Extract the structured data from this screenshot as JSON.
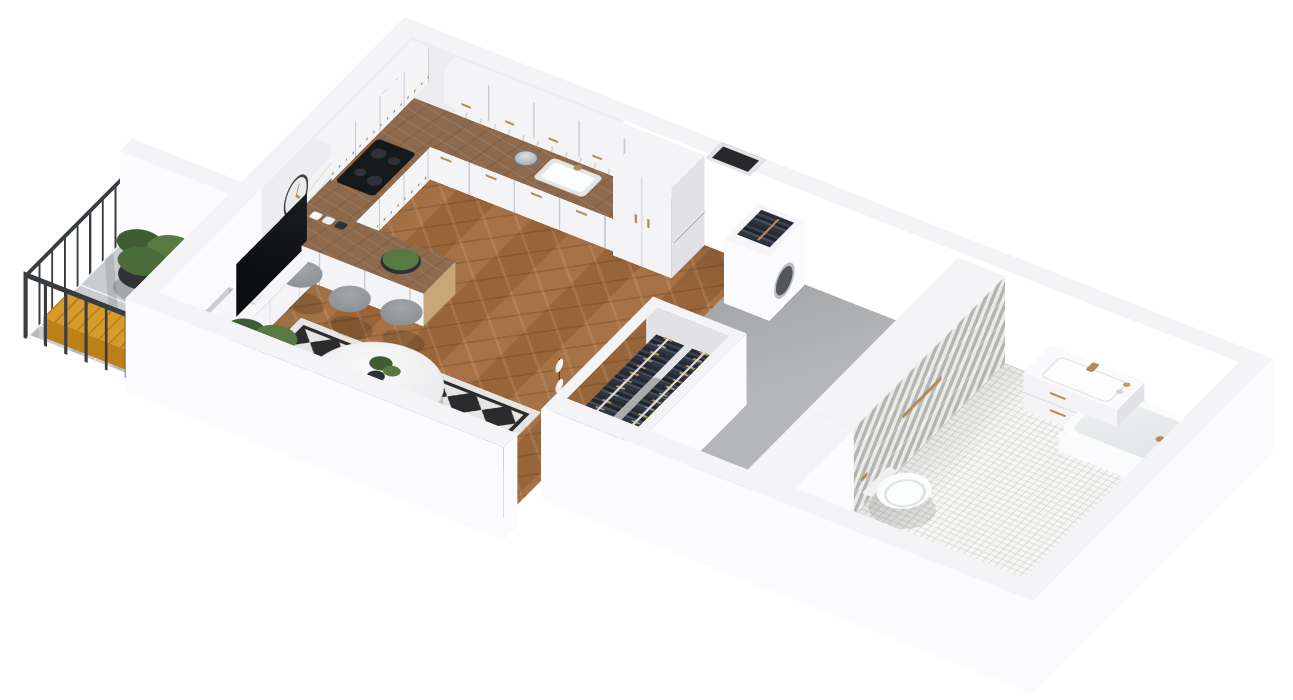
{
  "meta": {
    "type": "3d-apartment-floorplan-render",
    "background": "#ffffff"
  },
  "palette": {
    "wall_top": "#f4f4f6",
    "wall_outer": "#fbfbfd",
    "wall_int": "#ededf0",
    "wall_shade": "#e2e2e6",
    "wood_floor": "#a26b3c",
    "counter_wood": "#8d6a4d",
    "counter_light": "#c8a678",
    "concrete": "#b4b6b8",
    "balcony_tile": "#c9cdd0",
    "mosaic": "#f6f6f4",
    "chevron": "#cfcfcd",
    "rug_dark": "#2b2b2e",
    "rug_light": "#e6e5e1",
    "sofa": "#3a5574",
    "sofa_dark": "#2f486b",
    "pillow": "#eceff1",
    "purple": "#a05fb5",
    "gold": "#b08d57",
    "tv": "#141416",
    "dark": "#3a3d40",
    "black": "#1a1b1d",
    "stool": "#8f9294",
    "green": "#567a42",
    "green_dark": "#3f5c33",
    "orange": "#d89a2b",
    "orange_dark": "#bd7f18",
    "glass": "#c9ccce",
    "clock_face": "#eaebec",
    "door": "#f7f7f8"
  },
  "scene": {
    "living_room": {
      "objects": [
        "herringbone-wood-floor",
        "wall-clock",
        "butterfly-wall-art",
        "tv",
        "tv-stand",
        "potted-palm",
        "radiator",
        "diamond-pattern-rug",
        "round-coffee-table",
        "navy-sofa",
        "white-pillows",
        "purple-pillow",
        "floor-lamp",
        "balcony-door"
      ]
    },
    "kitchen": {
      "stool_count": 3,
      "objects": [
        "white-upper-cabinets",
        "white-base-cabinets",
        "tall-cabinet",
        "wood-countertop",
        "peninsula",
        "induction-cooktop",
        "sink",
        "gold-handles",
        "electric-kettle",
        "spice-jars",
        "serving-bowl",
        "bar-stools",
        "marble-backsplash"
      ]
    },
    "hallway": {
      "objects": [
        "entrance-door",
        "utility-unit-washer",
        "mini-clothes-rail",
        "concrete-floor",
        "ventilation-shaft"
      ]
    },
    "wardrobe": {
      "rows": 2,
      "objects": [
        "open-closet",
        "hanging-clothes",
        "wooden-hangers",
        "clothes-rails"
      ]
    },
    "bathroom": {
      "objects": [
        "chevron-tile-wall",
        "white-mosaic-tile",
        "round-gold-mirror",
        "vanity-with-drawers",
        "gold-faucet",
        "wall-hung-toilet",
        "gold-towel-bar",
        "toilet-paper-holder",
        "bathtub",
        "gold-shower-set"
      ]
    },
    "balcony": {
      "objects": [
        "metal-railing",
        "tile-floor",
        "potted-plant",
        "lantern",
        "orange-bench"
      ]
    }
  }
}
